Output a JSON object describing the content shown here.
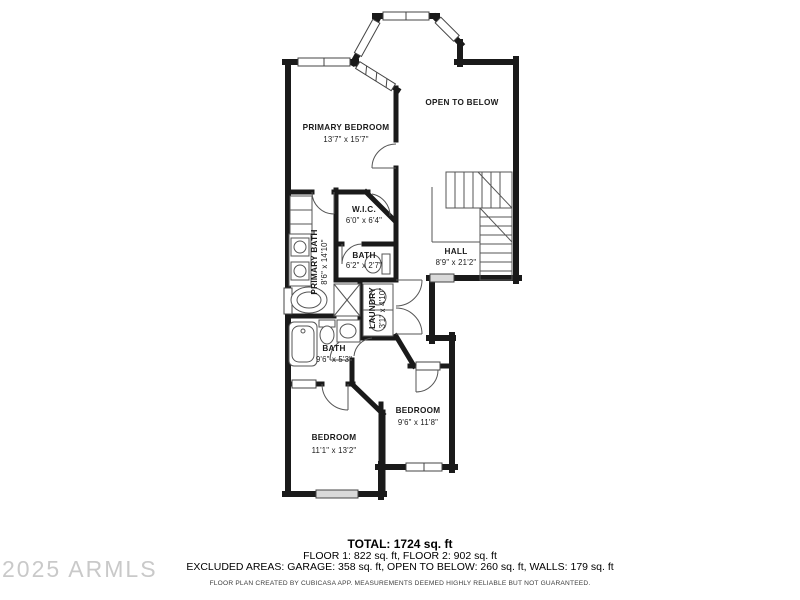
{
  "plan": {
    "rooms": {
      "primary_bedroom": {
        "name": "PRIMARY BEDROOM",
        "dims": "13'7\" x 15'7\""
      },
      "open_to_below": {
        "name": "OPEN TO BELOW",
        "dims": ""
      },
      "wic": {
        "name": "W.I.C.",
        "dims": "6'0\" x 6'4\""
      },
      "primary_bath": {
        "name": "PRIMARY BATH",
        "dims": "8'6\" x 14'10\""
      },
      "wc_bath": {
        "name": "BATH",
        "dims": "6'2\" x 2'7\""
      },
      "hall": {
        "name": "HALL",
        "dims": "8'9\" x 21'2\""
      },
      "laundry": {
        "name": "LAUNDRY",
        "dims": "3'1\" x 4'10\""
      },
      "hall_bath": {
        "name": "BATH",
        "dims": "9'6\" x 5'3\""
      },
      "bedroom_right": {
        "name": "BEDROOM",
        "dims": "9'6\" x 11'8\""
      },
      "bedroom_left": {
        "name": "BEDROOM",
        "dims": "11'1\" x 13'2\""
      }
    }
  },
  "summary": {
    "total": "TOTAL: 1724 sq. ft",
    "floors": "FLOOR 1: 822 sq. ft, FLOOR 2: 902 sq. ft",
    "excluded": "EXCLUDED AREAS: GARAGE: 358 sq. ft, OPEN TO BELOW: 260 sq. ft, WALLS: 179 sq. ft",
    "disclaimer": "FLOOR PLAN CREATED BY CUBICASA APP. MEASUREMENTS DEEMED HIGHLY RELIABLE BUT NOT GUARANTEED."
  },
  "watermark": "2025 ARMLS",
  "colors": {
    "wall": "#1a1a1a",
    "thin_line": "#555555",
    "window_fill": "#d9d9d9",
    "watermark": "#c9c9c9"
  }
}
